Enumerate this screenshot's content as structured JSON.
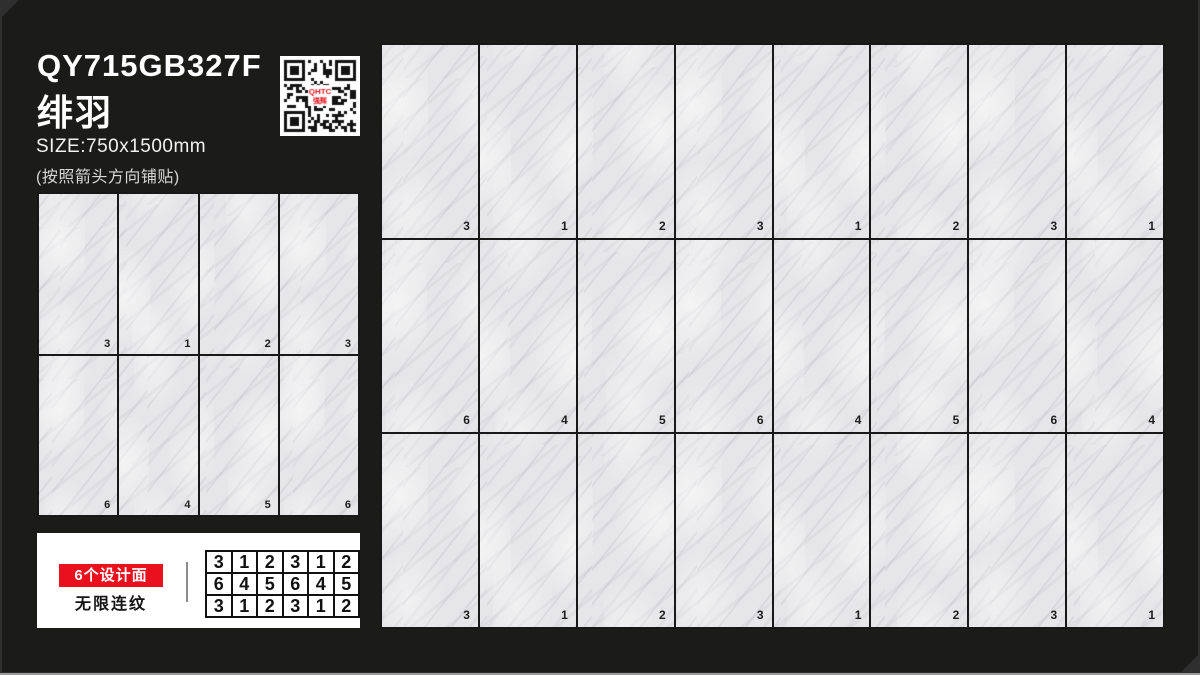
{
  "header": {
    "product_code": "QY715GB327F",
    "product_name": "绯羽",
    "size_label": "SIZE:750x1500mm",
    "note": "(按照箭头方向铺贴)"
  },
  "qr": {
    "logo_line1": "QHTC",
    "logo_line2": "强辉"
  },
  "preview_grid": {
    "rows": [
      [
        "3",
        "1",
        "2",
        "3"
      ],
      [
        "6",
        "4",
        "5",
        "6"
      ]
    ]
  },
  "info_box": {
    "badge": "6个设计面",
    "subtitle": "无限连纹",
    "pattern_table": [
      [
        "3",
        "1",
        "2",
        "3",
        "1",
        "2"
      ],
      [
        "6",
        "4",
        "5",
        "6",
        "4",
        "5"
      ],
      [
        "3",
        "1",
        "2",
        "3",
        "1",
        "2"
      ]
    ]
  },
  "layout_grid": {
    "rows": [
      [
        "3",
        "1",
        "2",
        "3",
        "1",
        "2",
        "3",
        "1"
      ],
      [
        "6",
        "4",
        "5",
        "6",
        "4",
        "5",
        "6",
        "4"
      ],
      [
        "3",
        "1",
        "2",
        "3",
        "1",
        "2",
        "3",
        "1"
      ]
    ]
  },
  "colors": {
    "accent_red": "#e8111d",
    "panel_bg": "#1b1b1a",
    "tile_base": "#e6e6e8",
    "grid_line": "#181818"
  }
}
